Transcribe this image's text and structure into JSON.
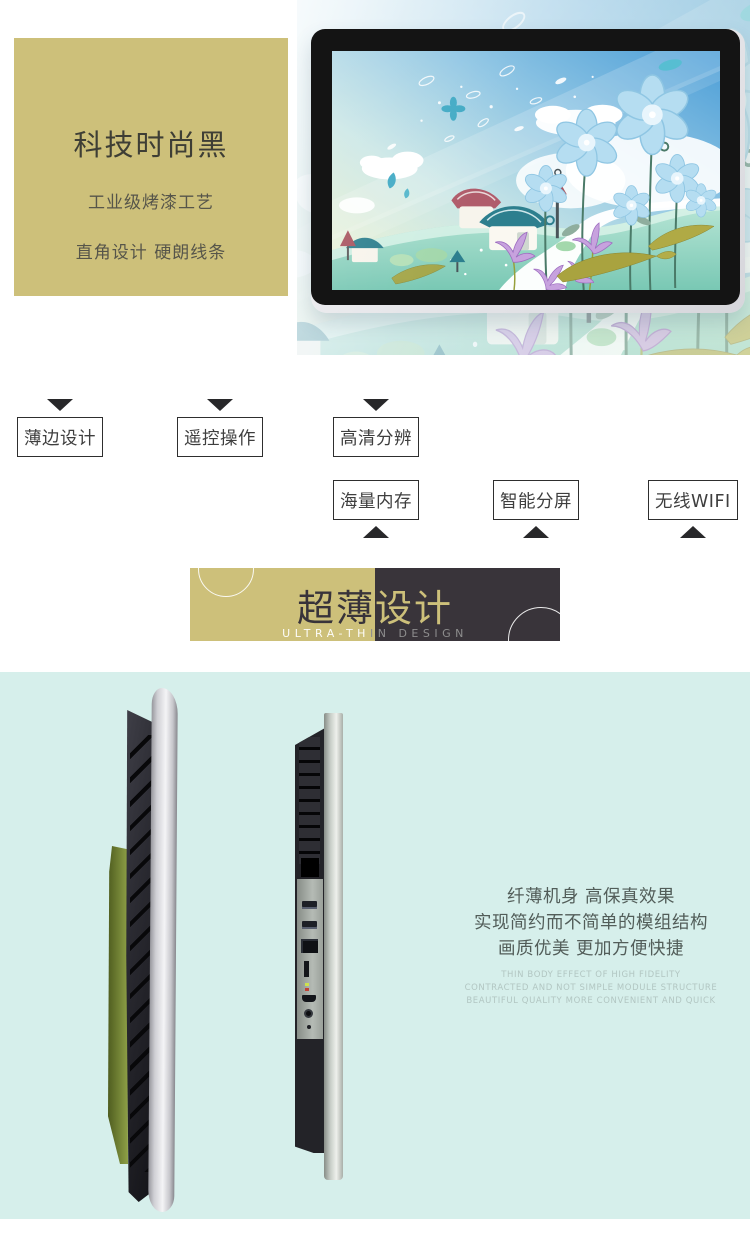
{
  "colors": {
    "khaki": "#cdc07a",
    "banner_dark": "#39343a",
    "thin_bg": "#d6efeb",
    "text_dark": "#3e3e35"
  },
  "hero": {
    "headline": "科技时尚黑",
    "line1": "工业级烤漆工艺",
    "line2": "直角设计 硬朗线条"
  },
  "features": {
    "row1": [
      {
        "label": "薄边设计"
      },
      {
        "label": "遥控操作"
      },
      {
        "label": "高清分辨"
      }
    ],
    "row2": [
      {
        "label": "海量内存"
      },
      {
        "label": "智能分屏"
      },
      {
        "label": "无线WIFI"
      }
    ]
  },
  "banner": {
    "title": {
      "left": "超薄",
      "right": "设计"
    },
    "subtitle": {
      "left": "ULTRA-TH",
      "right": "IN DESIGN"
    }
  },
  "thin_section": {
    "cn_lines": [
      "纤薄机身 高保真效果",
      "实现简约而不简单的模组结构",
      "画质优美 更加方便快捷"
    ],
    "en_lines": [
      "THIN BODY EFFECT OF HIGH FIDELITY",
      "CONTRACTED AND NOT SIMPLE MODULE STRUCTURE",
      "BEAUTIFUL QUALITY MORE CONVENIENT AND QUICK"
    ]
  }
}
